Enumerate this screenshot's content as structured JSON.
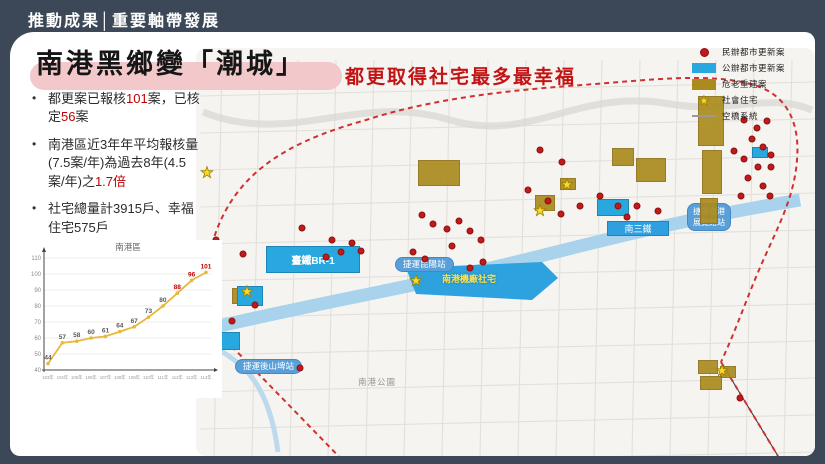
{
  "header": {
    "title": "推動成果│重要軸帶發展"
  },
  "slide": {
    "title": "南港黑鄉變「潮城」",
    "subtitle": "都更取得社宅最多最幸福",
    "bullets": [
      {
        "segments": [
          {
            "t": "都更案已報核"
          },
          {
            "t": "101",
            "red": true
          },
          {
            "t": "案，已核定"
          },
          {
            "t": "56",
            "red": true
          },
          {
            "t": "案"
          }
        ]
      },
      {
        "segments": [
          {
            "t": "南港區近3年年平均報核量(7.5案/年)為過去8年(4.5案/年)之"
          },
          {
            "t": "1.7倍",
            "red": true
          }
        ]
      },
      {
        "segments": [
          {
            "t": "社宅總量計3915戶、幸福住宅575戶"
          }
        ]
      }
    ]
  },
  "chart_data": {
    "type": "line",
    "title": "南港區",
    "categories": [
      "103年",
      "104年",
      "105年",
      "106年",
      "107年",
      "108年",
      "109年",
      "110年",
      "111年",
      "112年",
      "113年",
      "114年"
    ],
    "values": [
      44,
      57,
      58,
      60,
      61,
      64,
      67,
      73,
      80,
      88,
      96,
      101
    ],
    "ylim": [
      40,
      110
    ],
    "ytick_step": 10,
    "grid": true,
    "xlabel": "",
    "ylabel": "",
    "legend_position": "none",
    "line_color": "#e8b83a",
    "label_color": "#595959",
    "highlight_color": "#c00000",
    "highlight_from_index": 9
  },
  "legend": {
    "items": [
      {
        "icon": "red-dot",
        "label": "民辦都市更新案"
      },
      {
        "icon": "blue-rect",
        "label": "公辦都市更新案"
      },
      {
        "icon": "olive-rect",
        "label": "危老重建案"
      },
      {
        "icon": "yellow-star",
        "label": "社會住宅"
      },
      {
        "icon": "gray-line",
        "label": "空橋系統"
      }
    ]
  },
  "map": {
    "station_labels": [
      {
        "text": "捷運昆陽站",
        "x": 386,
        "y": 226
      },
      {
        "text": "捷運後山埤站",
        "x": 226,
        "y": 328
      },
      {
        "text": "捷運南港",
        "text2": "展覽館站",
        "x": 678,
        "y": 172
      }
    ],
    "area_labels": [
      {
        "text": "臺鐵BR-1",
        "style": "blue-area",
        "x": 256,
        "y": 214,
        "w": 94,
        "h": 27
      },
      {
        "text": "南三鐵",
        "style": "blue-bar",
        "x": 597,
        "y": 189,
        "w": 62,
        "h": 15
      },
      {
        "text": "南港機廠社宅",
        "style": "yellow-text",
        "x": 432,
        "y": 240
      },
      {
        "text": "南港公園",
        "style": "gray-text",
        "x": 348,
        "y": 344
      }
    ],
    "colors": {
      "private_case_dot": "#c01b1b",
      "public_case_block": "#29a8e0",
      "aging_rebuild_block": "#ab8b1e",
      "social_housing_star": "#ffd92b",
      "district_boundary": "#d03030",
      "rail_river_band": "#a9d2ec"
    },
    "blue_blocks": [
      [
        587,
        167,
        32,
        17
      ],
      [
        227,
        254,
        26,
        20
      ],
      [
        742,
        115,
        16,
        11
      ],
      [
        188,
        300,
        42,
        18
      ]
    ],
    "olive_blocks": [
      [
        408,
        128,
        42,
        26
      ],
      [
        602,
        116,
        22,
        18
      ],
      [
        626,
        126,
        30,
        24
      ],
      [
        688,
        64,
        26,
        50
      ],
      [
        692,
        118,
        20,
        44
      ],
      [
        690,
        166,
        18,
        26
      ],
      [
        688,
        328,
        20,
        14
      ],
      [
        710,
        334,
        16,
        12
      ],
      [
        690,
        344,
        22,
        14
      ],
      [
        222,
        256,
        18,
        16
      ],
      [
        525,
        163,
        20,
        16
      ],
      [
        550,
        146,
        16,
        12
      ]
    ],
    "stars": [
      [
        197,
        141
      ],
      [
        406,
        249
      ],
      [
        530,
        179
      ],
      [
        557,
        153
      ],
      [
        237,
        260
      ],
      [
        712,
        339
      ],
      [
        196,
        302
      ]
    ],
    "red_dots": [
      [
        206,
        208
      ],
      [
        233,
        222
      ],
      [
        292,
        196
      ],
      [
        322,
        208
      ],
      [
        331,
        220
      ],
      [
        342,
        211
      ],
      [
        351,
        219
      ],
      [
        316,
        225
      ],
      [
        245,
        273
      ],
      [
        222,
        289
      ],
      [
        290,
        336
      ],
      [
        412,
        183
      ],
      [
        423,
        192
      ],
      [
        437,
        197
      ],
      [
        449,
        189
      ],
      [
        460,
        199
      ],
      [
        471,
        208
      ],
      [
        442,
        214
      ],
      [
        415,
        227
      ],
      [
        403,
        220
      ],
      [
        460,
        236
      ],
      [
        473,
        230
      ],
      [
        530,
        118
      ],
      [
        552,
        130
      ],
      [
        518,
        158
      ],
      [
        538,
        169
      ],
      [
        551,
        182
      ],
      [
        570,
        174
      ],
      [
        590,
        164
      ],
      [
        608,
        174
      ],
      [
        627,
        174
      ],
      [
        648,
        179
      ],
      [
        617,
        185
      ],
      [
        734,
        88
      ],
      [
        747,
        96
      ],
      [
        757,
        89
      ],
      [
        742,
        107
      ],
      [
        753,
        115
      ],
      [
        761,
        123
      ],
      [
        734,
        127
      ],
      [
        748,
        135
      ],
      [
        761,
        135
      ],
      [
        738,
        146
      ],
      [
        753,
        154
      ],
      [
        731,
        164
      ],
      [
        760,
        164
      ],
      [
        724,
        119
      ],
      [
        730,
        366
      ]
    ]
  }
}
